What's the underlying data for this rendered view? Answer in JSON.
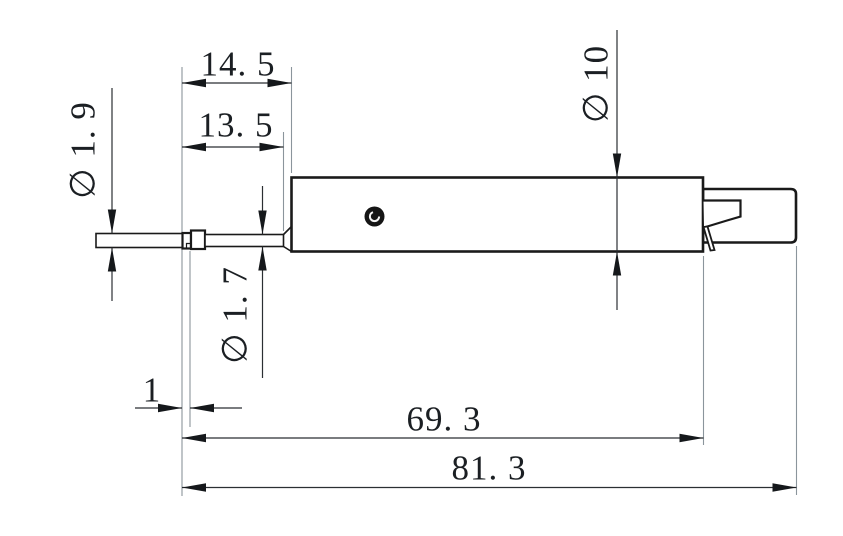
{
  "drawing": {
    "type": "technical-drawing",
    "view": "Side view of a fiber-optic probe body with protruding fiber tip and rear connector",
    "background_color": "#ffffff",
    "outline_color": "#1a1a1a",
    "dimension_color": "#2b2f33",
    "extension_line_color": "#8b959c",
    "dimensions": {
      "tip_to_body_face": "14. 5",
      "bare_fiber_length": "13. 5",
      "tip_diameter": "∅ 1. 9",
      "fiber_diameter": "∅ 1. 7",
      "collar_width": "1",
      "body_diameter": "∅ 10",
      "body_length": "69. 3",
      "overall_length": "81. 3"
    }
  }
}
